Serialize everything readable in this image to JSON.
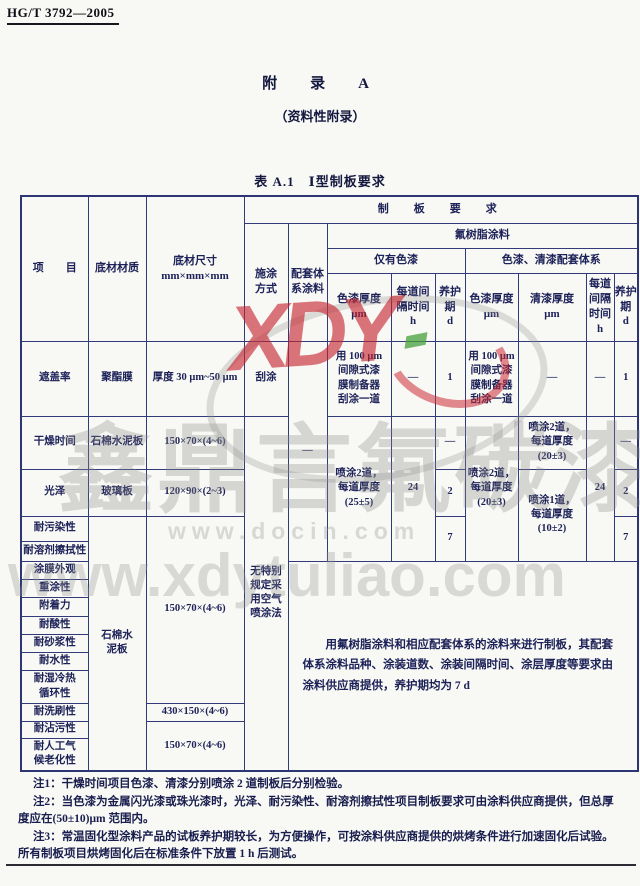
{
  "page": {
    "doc_code": "HG/T 3792—2005",
    "appendix_title": "附　录　A",
    "appendix_subtitle": "（资料性附录）",
    "table_title": "表 A.1　Ⅰ型制板要求"
  },
  "table": {
    "header": {
      "item": "项　　目",
      "material": "底材材质",
      "size": "底材尺寸\nmm×mm×mm",
      "panel_requirement": "制　板　要　求",
      "apply_method": "施涂\n方式",
      "system_coating": "配套体\n系涂料",
      "fluororesin": "氟树脂涂料",
      "only_paint": "仅有色漆",
      "paint_varnish_system": "色漆、清漆配套体系",
      "paint_thickness_a": "色漆厚度\nμm",
      "interval_a": "每道间\n隔时间\nh",
      "cure_a": "养护\n期\nd",
      "paint_thickness_b": "色漆厚度\nμm",
      "varnish_thickness_b": "清漆厚度\nμm",
      "interval_b": "每道\n间隔\n时间\nh",
      "cure_b": "养护\n期\nd"
    },
    "rows": {
      "system_dash": "—",
      "hiding_power": {
        "item": "遮盖率",
        "material": "聚酯膜",
        "size": "厚度 30 μm~50 μm",
        "method": "刮涂",
        "paint_a": "用 100 μm\n间隙式漆\n膜制备器\n刮涂一道",
        "interval_a": "—",
        "cure_a": "1",
        "paint_b": "用 100 μm\n间隙式漆\n膜制备器\n刮涂一道",
        "varnish_b": "—",
        "interval_b": "—",
        "cure_b": "1"
      },
      "drying_time": {
        "item": "干燥时间",
        "material": "石棉水泥板",
        "size": "150×70×(4~6)",
        "cure_a": "—",
        "varnish_b": "喷涂2道，\n每道厚度\n(20±3)",
        "cure_b": "—"
      },
      "gloss": {
        "item": "光泽",
        "material": "玻璃板",
        "size": "120×90×(2~3)",
        "cure_a": "2",
        "cure_b": "2"
      },
      "merged": {
        "method": "无特别\n规定采\n用空气\n喷涂法",
        "paint_a": "喷涂2道，\n每道厚度\n(25±5)",
        "interval_a": "24",
        "cure_a7": "7",
        "paint_b": "喷涂2道，\n每道厚度\n(20±3)",
        "varnish_b2": "喷涂1道，\n每道厚度\n(10±2)",
        "interval_b": "24",
        "cure_b7": "7"
      },
      "stain": "耐污染性",
      "solvent_rub": "耐溶剂擦拭性",
      "film_appearance": "涂膜外观",
      "recoat": "重涂性",
      "adhesion": "附着力",
      "acid": "耐酸性",
      "mortar": "耐砂浆性",
      "water": "耐水性",
      "humid_cycle": "耐湿冷热\n循环性",
      "scrub": "耐洗刷性",
      "dirt": "耐沾污性",
      "weathering": "耐人工气\n候老化性",
      "lower_material": "石棉水\n泥板",
      "lower_size_main": "150×70×(4~6)",
      "lower_size_scrub": "430×150×(4~6)",
      "lower_size_weather": "150×70×(4~6)",
      "combined_note": "用氟树脂涂料和相应配套体系的涂料来进行制板，其配套体系涂料品种、涂装道数、涂装间隔时间、涂层厚度等要求由涂料供应商提供，养护期均为 7 d"
    }
  },
  "notes": {
    "line1": "注1：干燥时间项目色漆、清漆分别喷涂 2 道制板后分别检验。",
    "line2": "注2：当色漆为金属闪光漆或珠光漆时，光泽、耐污染性、耐溶剂擦拭性项目制板要求可由涂料供应商提供，但总厚",
    "line3": "度应在(50±10)μm 范围内。",
    "line4": "注3：常温固化型涂料产品的试板养护期较长，为方便操作，可按涂料供应商提供的烘烤条件进行加速固化后试验。",
    "line5": "所有制板项目烘烤固化后在标准条件下放置 1 h 后测试。"
  },
  "watermarks": {
    "logo_text": "XDY",
    "brand_text": "鑫鼎言氟碳漆",
    "docin_text": "www.docin.com",
    "url_text": "www.xdytuliao.com"
  },
  "colors": {
    "ink": "#1c2158",
    "border": "#323a7a",
    "logo_red": "#c5232d",
    "logo_green": "#46a03c",
    "watermark_gray": "#8c8c8c"
  }
}
